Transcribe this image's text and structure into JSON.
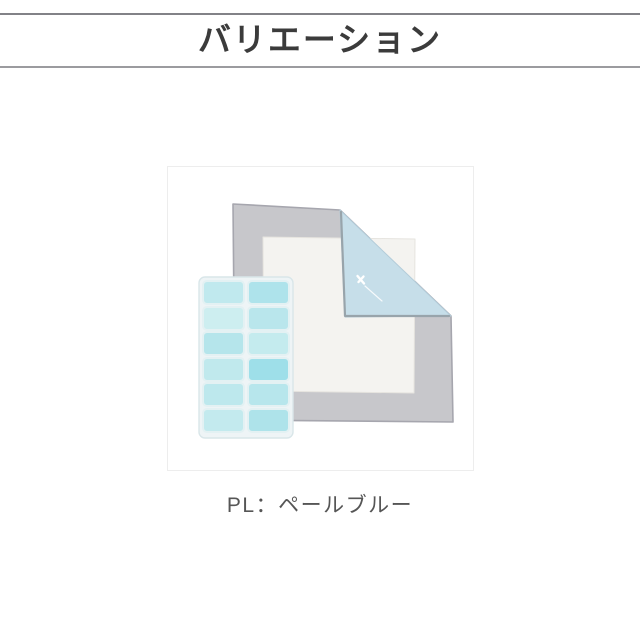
{
  "header": {
    "title": "バリエーション",
    "title_color": "#3b3b3b",
    "rule_top_color": "#828287",
    "rule_bottom_color": "#9b9b9f"
  },
  "figure": {
    "border_color": "#ededed",
    "background_color": "#ffffff",
    "blanket": {
      "shell_color": "#c7c7cb",
      "edge_trim_color": "#a6a6ae",
      "panel_color": "#f4f3f0",
      "fold_color": "#c6dee9",
      "fold_trim_color": "#98a4ab",
      "brand_mark_color": "#ffffff"
    },
    "gel_pad": {
      "frame_color": "#eef4f6",
      "cell_colors": [
        "#c0e9ee",
        "#aee3eb",
        "#cdeef0",
        "#b9e6ec",
        "#b5e5eb",
        "#c4ebee",
        "#c0e9ed",
        "#9edfe9",
        "#bde8ed",
        "#b7e6ec",
        "#c3eaee",
        "#aee3ea"
      ]
    }
  },
  "caption": {
    "label": "PL：ペールブルー",
    "color": "#565656"
  }
}
